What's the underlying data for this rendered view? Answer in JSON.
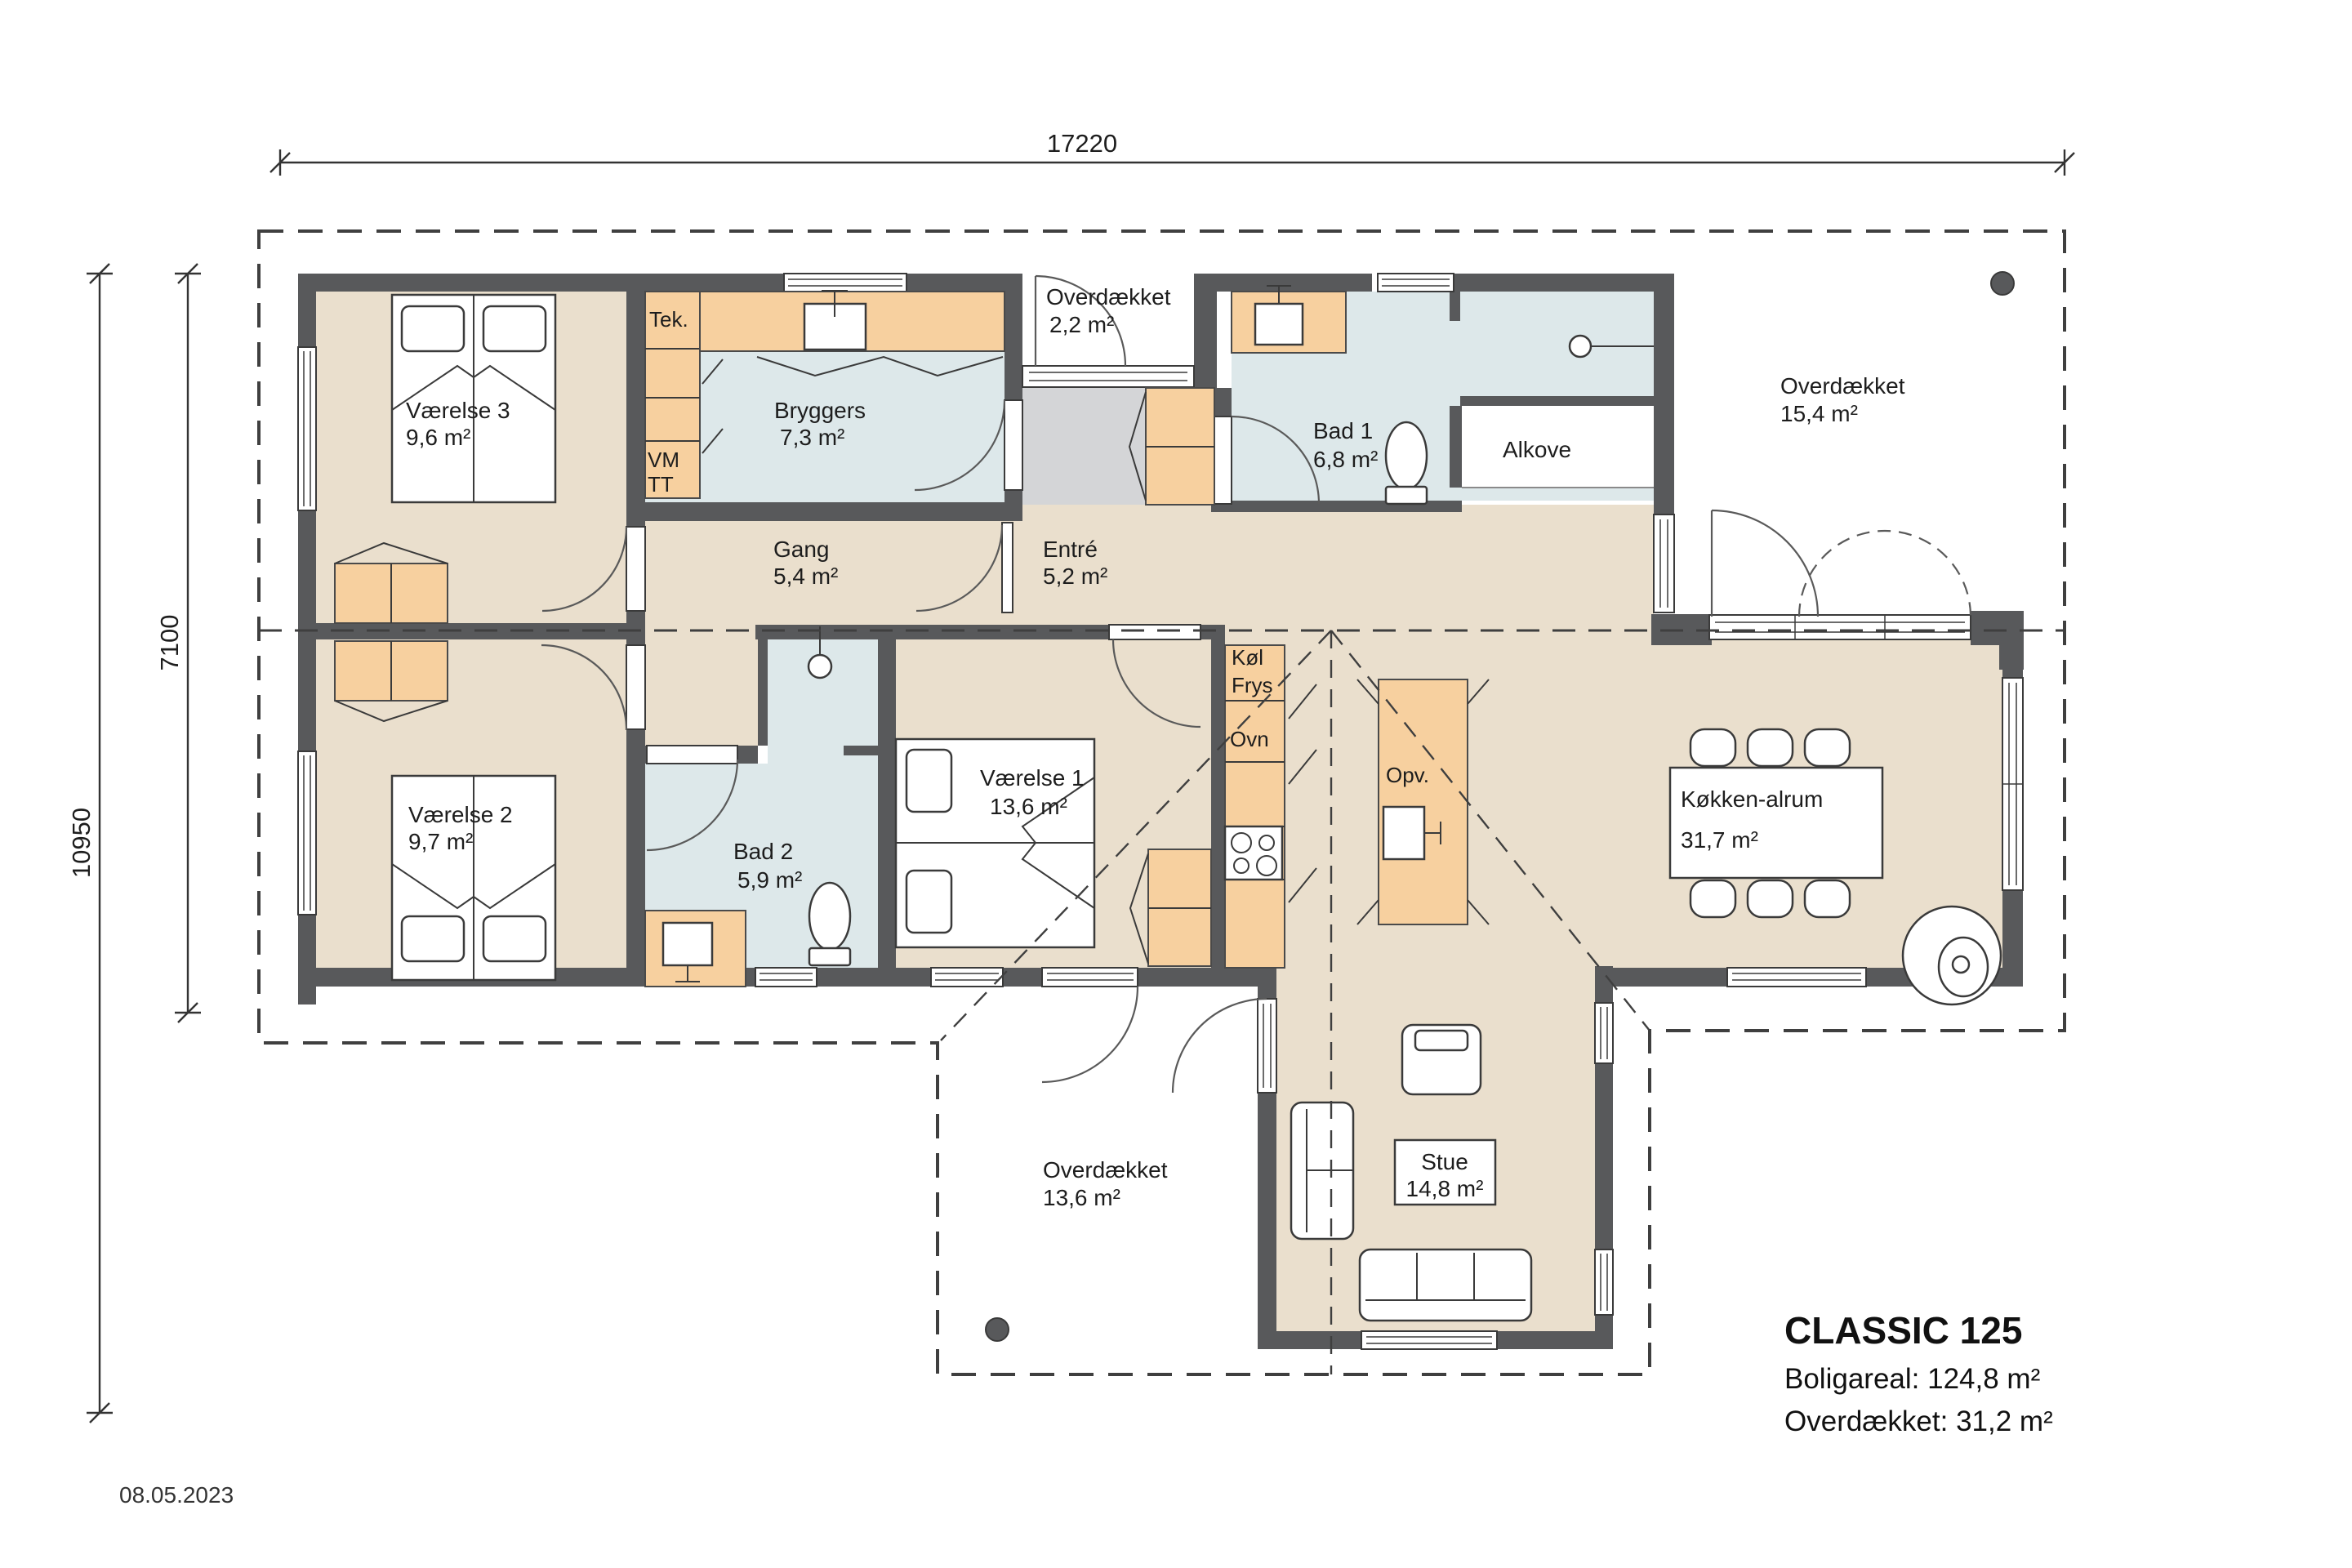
{
  "title_block": {
    "title": "CLASSIC 125",
    "line1": "Boligareal: 124,8 m²",
    "line2": "Overdækket: 31,2 m²"
  },
  "date": "08.05.2023",
  "dimensions": {
    "top": "17220",
    "left_inner": "7100",
    "left_outer": "10950"
  },
  "rooms": {
    "vaerelse3": {
      "name": "Værelse 3",
      "area": "9,6 m²"
    },
    "vaerelse2": {
      "name": "Værelse 2",
      "area": "9,7 m²"
    },
    "vaerelse1": {
      "name": "Værelse 1",
      "area": "13,6 m²"
    },
    "bryggers": {
      "name": "Bryggers",
      "area": "7,3 m²"
    },
    "bad1": {
      "name": "Bad 1",
      "area": "6,8 m²"
    },
    "bad2": {
      "name": "Bad 2",
      "area": "5,9 m²"
    },
    "gang": {
      "name": "Gang",
      "area": "5,4 m²"
    },
    "entre": {
      "name": "Entré",
      "area": "5,2 m²"
    },
    "kokken": {
      "name": "Køkken-alrum",
      "area": "31,7 m²"
    },
    "stue": {
      "name": "Stue",
      "area": "14,8 m²"
    },
    "alkove": {
      "name": "Alkove"
    },
    "ov22": {
      "name": "Overdækket",
      "area": "2,2 m²"
    },
    "ov154": {
      "name": "Overdækket",
      "area": "15,4 m²"
    },
    "ov136": {
      "name": "Overdækket",
      "area": "13,6 m²"
    }
  },
  "fixtures": {
    "tek": "Tek.",
    "vm": "VM",
    "tt": "TT",
    "kol": "Køl",
    "frys": "Frys",
    "ovn": "Ovn",
    "opv": "Opv."
  },
  "colors": {
    "wall": "#58595b",
    "floor": "#eadfcd",
    "wet": "#dde8ea",
    "cabinet": "#f7d09f",
    "entry": "#d4d5d7"
  }
}
